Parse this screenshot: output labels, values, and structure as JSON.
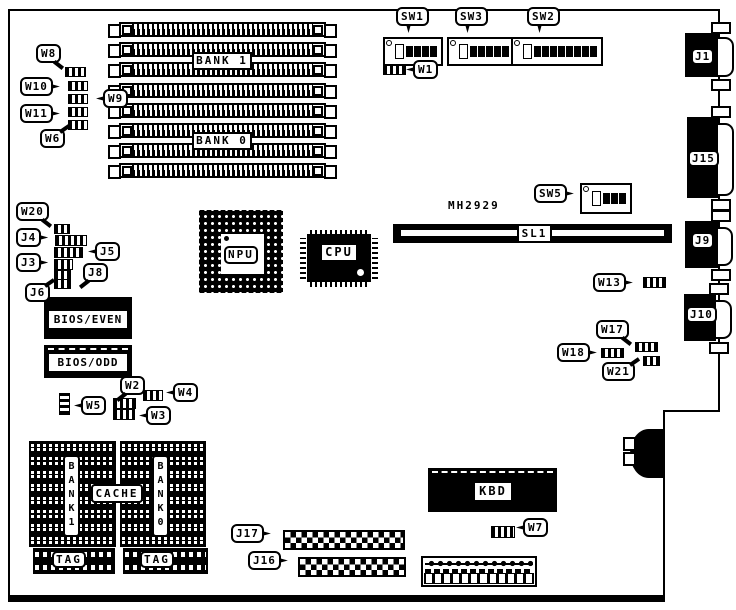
{
  "colors": {
    "ink": "#000000",
    "paper": "#ffffff"
  },
  "memory": {
    "rows": 8,
    "bank1_label": "BANK 1",
    "bank0_label": "BANK 0"
  },
  "top_jumpers": {
    "w8": "W8",
    "w10": "W10",
    "w9": "W9",
    "w11": "W11",
    "w6": "W6"
  },
  "dip_switches": {
    "sw1": {
      "label": "SW1",
      "positions": 5
    },
    "sw3": {
      "label": "SW3",
      "positions": 6
    },
    "sw2": {
      "label": "SW2",
      "positions": 9
    },
    "sw5": {
      "label": "SW5",
      "positions": 4
    }
  },
  "jumpers": {
    "w1": "W1",
    "w2": "W2",
    "w3": "W3",
    "w4": "W4",
    "w5": "W5",
    "w7": "W7",
    "w13": "W13",
    "w17": "W17",
    "w18": "W18",
    "w20": "W20",
    "w21": "W21"
  },
  "headers": {
    "j3": "J3",
    "j4": "J4",
    "j5": "J5",
    "j6": "J6",
    "j8": "J8",
    "j16": "J16",
    "j17": "J17"
  },
  "bios": {
    "even": "BIOS/EVEN",
    "odd": "BIOS/ODD"
  },
  "chips": {
    "npu": "NPU",
    "cpu": "CPU",
    "kbd": "KBD"
  },
  "slot": {
    "part": "MH2929",
    "label": "SL1"
  },
  "edge_connectors": {
    "j1": "J1",
    "j15": "J15",
    "j9": "J9",
    "j10": "J10"
  },
  "cache": {
    "rows": 8,
    "label": "CACHE",
    "bank1": "BANK1",
    "bank0": "BANK0",
    "tag_left": "TAG",
    "tag_right": "TAG"
  },
  "bottom": {
    "terminal_pins": 12
  }
}
